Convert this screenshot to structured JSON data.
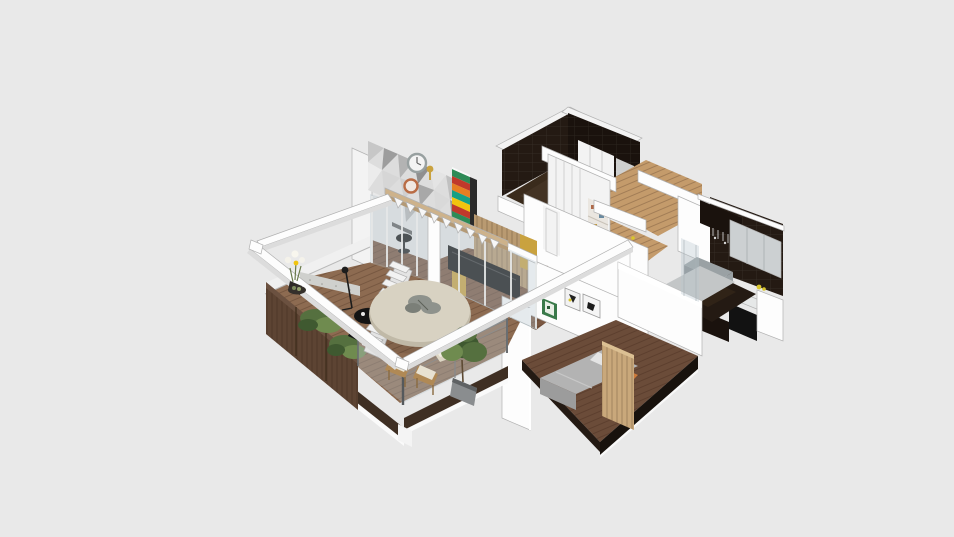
{
  "scene": {
    "type": "isometric-3d-floorplan-render",
    "description": "cutaway axonometric render of an apartment",
    "rooms": [
      {
        "name": "balcony-terrace"
      },
      {
        "name": "living-room"
      },
      {
        "name": "accent-feature-room"
      },
      {
        "name": "hallway-dining"
      },
      {
        "name": "wardrobe-closet"
      },
      {
        "name": "bathroom"
      },
      {
        "name": "kitchen"
      },
      {
        "name": "bedroom"
      }
    ],
    "objects": [
      {
        "name": "pergola-beams"
      },
      {
        "name": "round-outdoor-table"
      },
      {
        "name": "table-centerpiece"
      },
      {
        "name": "side-table"
      },
      {
        "name": "outdoor-chairs"
      },
      {
        "name": "lounge-chair"
      },
      {
        "name": "potted-plant"
      },
      {
        "name": "planter-boxes"
      },
      {
        "name": "flower-vase"
      },
      {
        "name": "glass-railing"
      },
      {
        "name": "staircase"
      },
      {
        "name": "bunting-flags"
      },
      {
        "name": "geometric-accent-wall"
      },
      {
        "name": "wall-clock"
      },
      {
        "name": "copper-ring-decor"
      },
      {
        "name": "chevron-bookshelf"
      },
      {
        "name": "tv-panel"
      },
      {
        "name": "wood-slat-partition"
      },
      {
        "name": "gold-mosaic-panels"
      },
      {
        "name": "sliding-glass-doors"
      },
      {
        "name": "wardrobe"
      },
      {
        "name": "dining-set"
      },
      {
        "name": "kitchen-counters"
      },
      {
        "name": "fridge-cabinet"
      },
      {
        "name": "cooktop"
      },
      {
        "name": "bed"
      },
      {
        "name": "headboard-panel"
      },
      {
        "name": "wall-art-frames"
      }
    ]
  },
  "palette": {
    "bg": "#e9e9e9",
    "wallWhite": "#fdfdfd",
    "wallLight": "#f3f3f3",
    "wallShade": "#dcdcdc",
    "wallDim": "#c9c9c9",
    "outline": "#b2b2b2",
    "metal": "#8a8f92",
    "glassTint": "#b8c6cd",
    "deckWood": "#8d6b51",
    "deckDark": "#77573f",
    "fasciaDark": "#3f2f23",
    "planterWood": "#5d4433",
    "woodFloor": "#7a5741",
    "hallWood": "#c49b6b",
    "bedroomFloor": "#6b4c39",
    "slabDark": "#18120d",
    "darkWall": "#241a13",
    "darkWall2": "#1a120d",
    "glossDark": "#3a2b1c",
    "grayCab": "#ccd0d2",
    "grayMid": "#9aa1a4",
    "grayDark": "#878e91",
    "counterWhite": "#e6e8e8",
    "concrete": "#c3c6c7",
    "tableTop": "#d8d2c2",
    "tableRim": "#c0b9a7",
    "centerpiece": "#8e928c",
    "green1": "#55703f",
    "green2": "#3f5930",
    "green3": "#6f8b4f",
    "chev1": "#c0392b",
    "chev2": "#e67e22",
    "chev3": "#16a085",
    "chev4": "#f1c40f",
    "chev5": "#2e8b57",
    "gold": "#c9a23f",
    "tvBlack": "#121212",
    "slatWood": "#b99a71",
    "bedGray": "#b3b3b3",
    "bedGrayDark": "#9c9c9c",
    "orangeAccent": "#cd7a3a",
    "headboard": "#c9a87b",
    "clockRing": "#98a0a0",
    "copper": "#b96c45",
    "artGreen": "#3a7a4a",
    "flagWhite": "#f7f7f7",
    "stepWhite": "#f2f2f2",
    "stairSide": "#e4e4e4",
    "raftTan": "#cdb28b",
    "raftTanDark": "#b49a76",
    "lemon": "#d8c52c",
    "black1": "#141414"
  }
}
